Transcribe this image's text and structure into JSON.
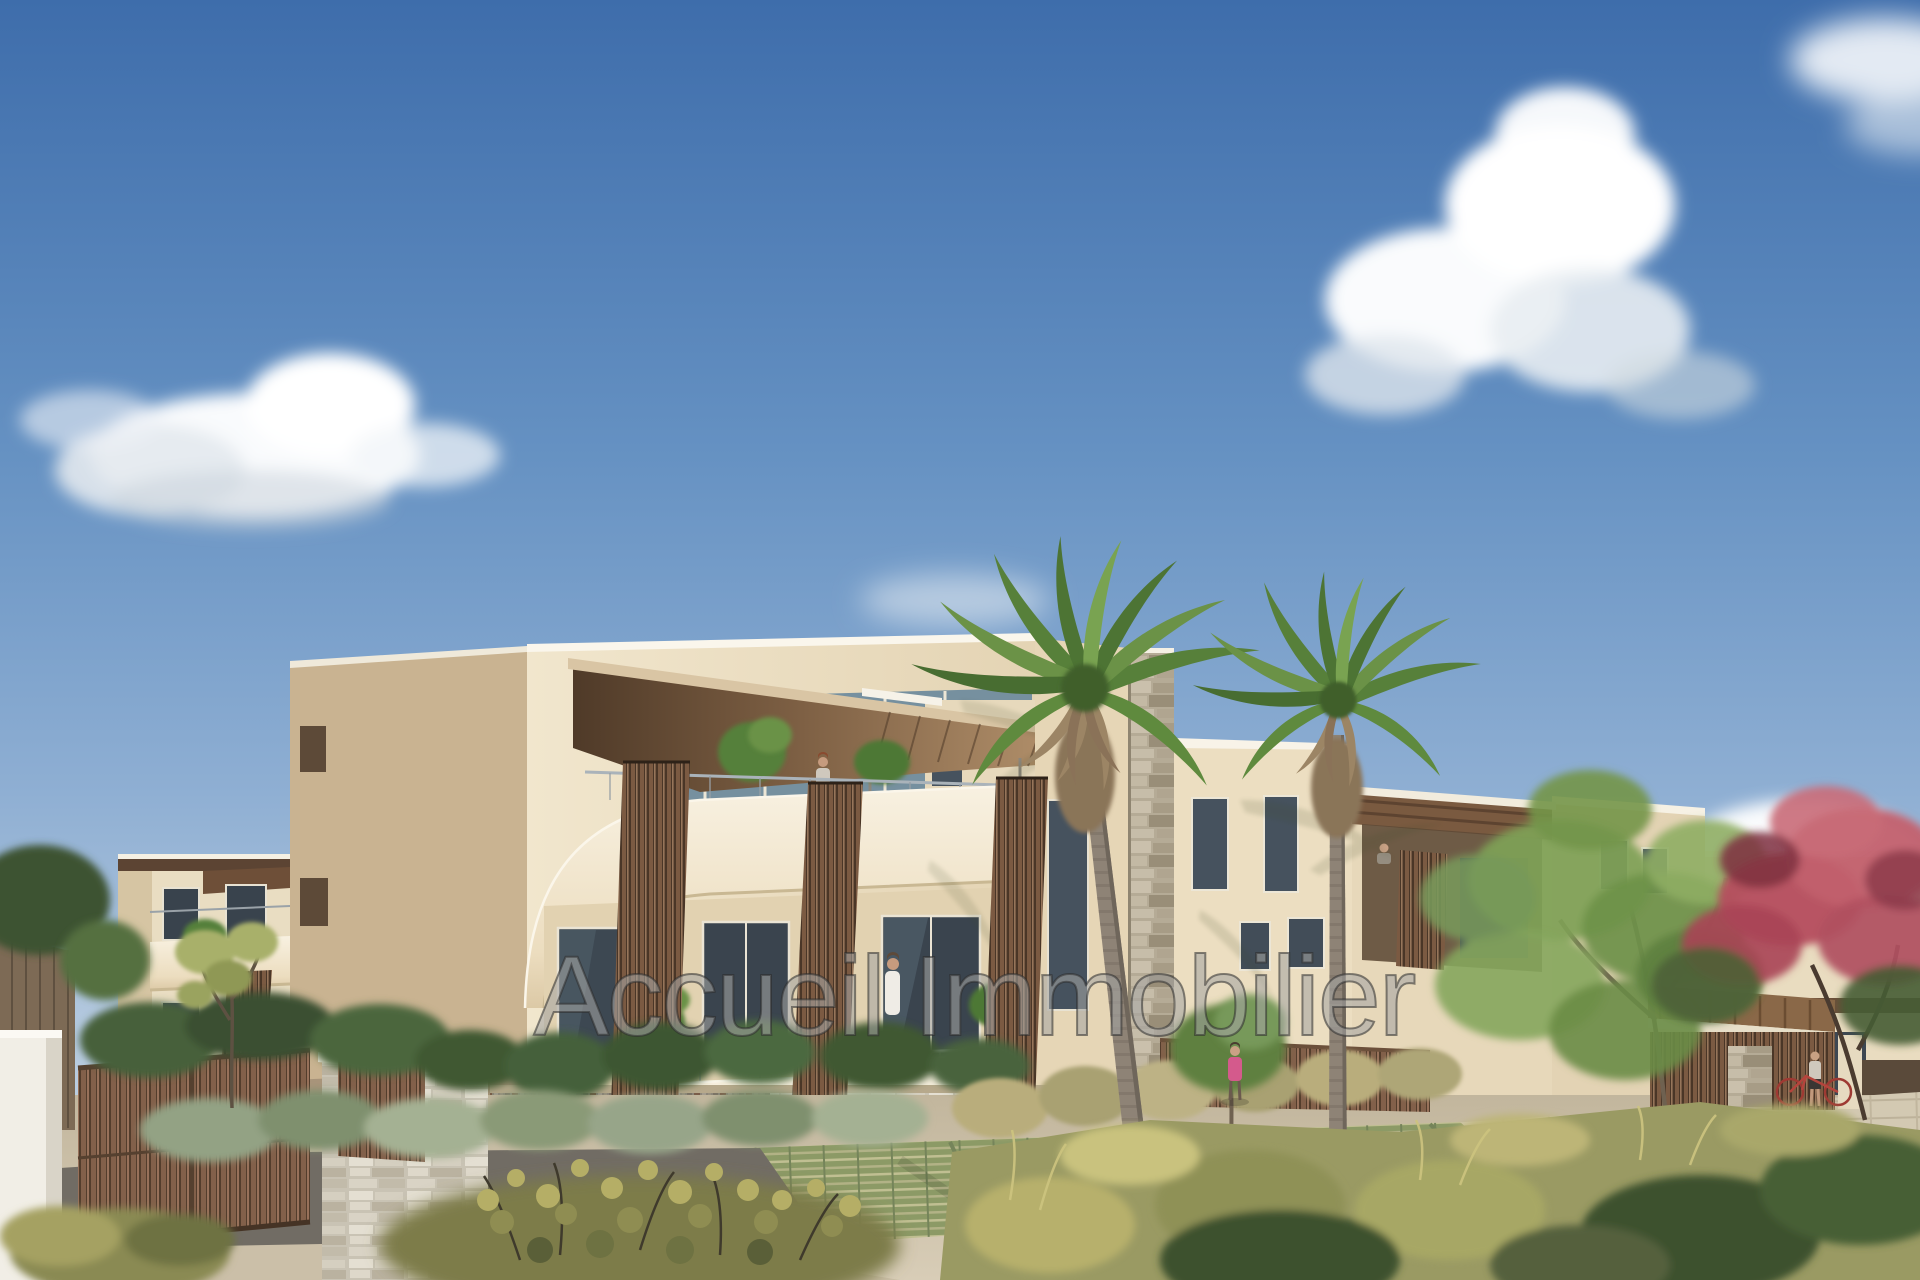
{
  "watermark": {
    "text": "Accueil Immobilier"
  },
  "scene": {
    "type": "architectural-render",
    "subject": "new-residential-building-exterior",
    "palette": {
      "sky_top": "#3e6dab",
      "sky_horizon": "#cfdae6",
      "cloud_white": "#ffffff",
      "facade_cream": "#eee3cb",
      "facade_shadow": "#c9b391",
      "balcony_band": "#f4ecda",
      "awning_dark": "#5a4230",
      "awning_light": "#b6946e",
      "wood_screen_brown": "#7b5a42",
      "stone_wall": "#d9d3c5",
      "glass_dark": "#3d4852",
      "glass_sky": "#7b93a7",
      "palm_green": "#5f8a3e",
      "palm_dead_frond": "#9c8565",
      "palm_trunk": "#8e8376",
      "tree_green": "#7fa055",
      "flower_tree_red": "#b54e5e",
      "shrub_sage": "#93a284",
      "grass_tan": "#b9ad7c",
      "meadow_green": "#9a9a63",
      "dark_foliage": "#3c512f",
      "ground_tan": "#cfc4ad",
      "grass_paver_green": "#8c9a66",
      "concrete_path": "#d3c9b2",
      "asphalt": "#716c64",
      "gate_brown": "#7f5d46",
      "white_pillar": "#f1eee6",
      "watermark_fill": "#f8f8f6",
      "watermark_outline": "#2d2d2d"
    }
  }
}
